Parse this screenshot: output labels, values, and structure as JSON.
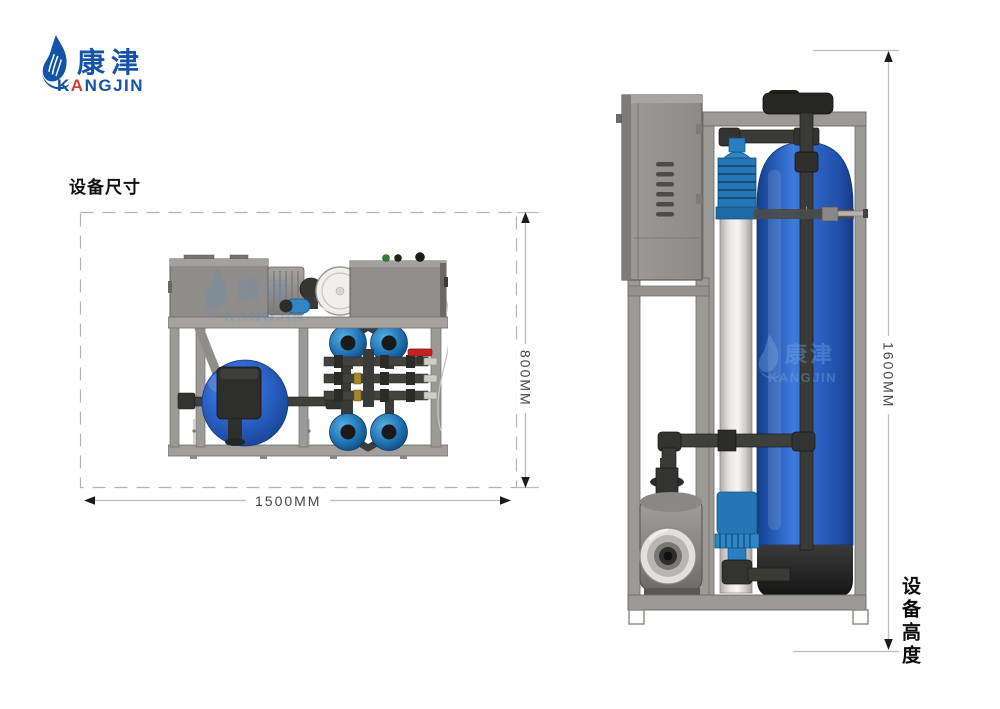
{
  "logo": {
    "icon": "flame-droplet-icon",
    "brand_cn": "康津",
    "en_part1": "K",
    "en_accent": "A",
    "en_part2": "NGJIN",
    "color_primary": "#1353a8",
    "color_accent": "#d63c31"
  },
  "section": {
    "title": "设备尺寸"
  },
  "dimensions": {
    "top_view_width": "1500MM",
    "top_view_depth": "800MM",
    "side_view_height": "1600MM",
    "height_caption": "设备高度"
  },
  "watermark": {
    "cn": "康津",
    "en": "KANGJIN"
  },
  "colors": {
    "frame_gray": "#9c9a97",
    "tank_blue": "#2f63c4",
    "fitting_blue": "#2576b4",
    "pipe_dark": "#3a3a3a",
    "valve_red": "#c32222",
    "dimension_line": "#bdbdbb"
  }
}
